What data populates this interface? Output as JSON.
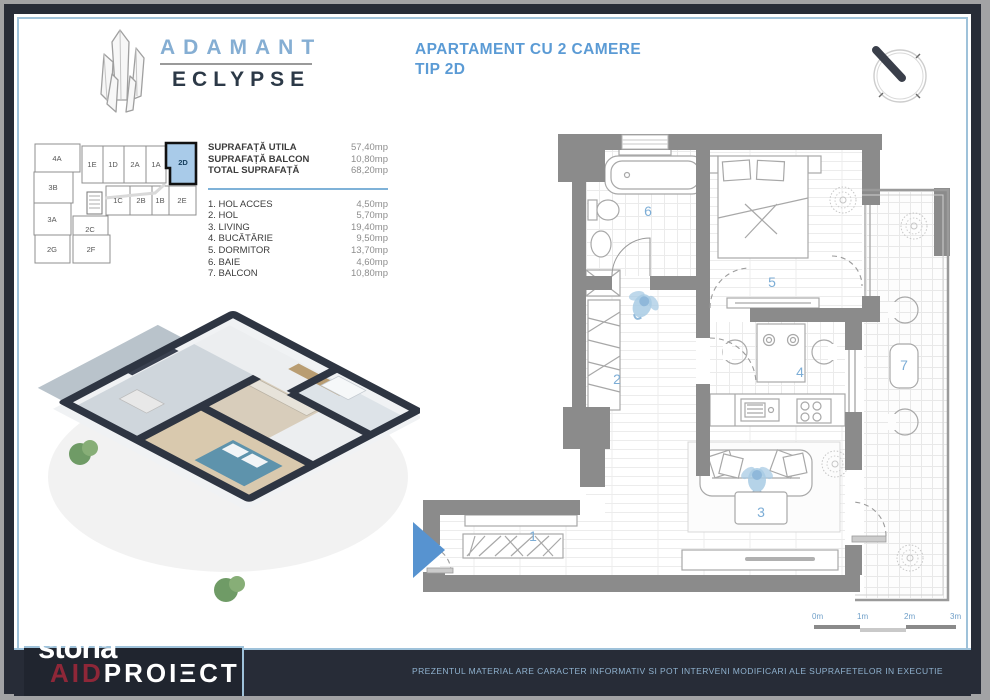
{
  "brand": {
    "name": "ADAMANT",
    "sub": "ECLYPSE"
  },
  "title": {
    "line1": "APARTAMENT CU 2 CAMERE",
    "line2": "TIP 2D"
  },
  "areas": {
    "summary": [
      {
        "label": "SUPRAFAȚĂ UTILA",
        "value": "57,40mp"
      },
      {
        "label": "SUPRAFAȚĂ BALCON",
        "value": "10,80mp"
      },
      {
        "label": "TOTAL SUPRAFAȚĂ",
        "value": "68,20mp"
      }
    ],
    "rooms": [
      {
        "label": "1. HOL ACCES",
        "value": "4,50mp"
      },
      {
        "label": "2. HOL",
        "value": "5,70mp"
      },
      {
        "label": "3. LIVING",
        "value": "19,40mp"
      },
      {
        "label": "4. BUCĂTĂRIE",
        "value": "9,50mp"
      },
      {
        "label": "5. DORMITOR",
        "value": "13,70mp"
      },
      {
        "label": "6. BAIE",
        "value": "4,60mp"
      },
      {
        "label": "7. BALCON",
        "value": "10,80mp"
      }
    ]
  },
  "keyplan": {
    "units": [
      "4A",
      "1E",
      "1D",
      "2A",
      "1A",
      "2D",
      "3B",
      "1C",
      "2B",
      "1B",
      "2E",
      "3A",
      "2C",
      "2G",
      "2F"
    ],
    "highlighted": "2D"
  },
  "plan": {
    "room_numbers": [
      "1",
      "2",
      "3",
      "4",
      "5",
      "6",
      "7"
    ]
  },
  "scalebar": {
    "labels": [
      "0m",
      "1m",
      "2m",
      "3m"
    ]
  },
  "footer": {
    "watermark": "storia",
    "logo_red": "AID",
    "logo_white": "PROIΞCT",
    "disclaimer": "PREZENTUL MATERIAL ARE CARACTER INFORMATIV SI POT INTERVENI MODIFICARI ALE SUPRAFETELOR IN EXECUTIE"
  },
  "colors": {
    "accent_blue": "#5b9bd5",
    "label_blue": "#7cadd6",
    "wall_gray": "#8b8b8b",
    "frame_navy": "#272c37",
    "highlight_unit": "#a9cbe9",
    "logo_red": "#8e2738",
    "border_blue": "#9fc2da"
  }
}
